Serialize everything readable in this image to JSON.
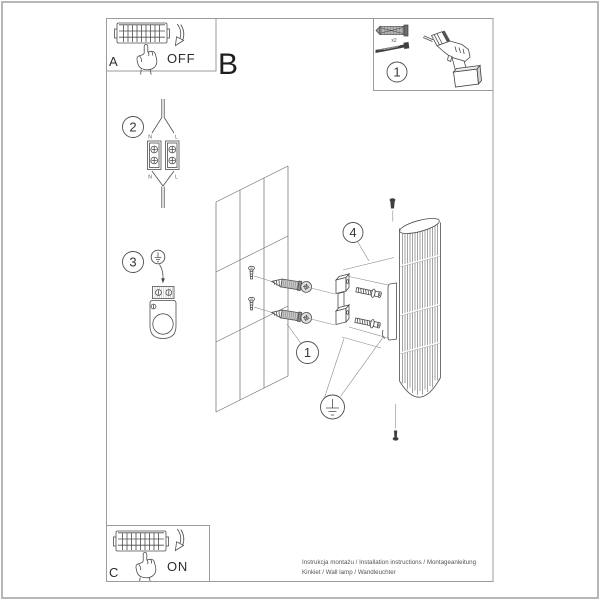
{
  "panels": {
    "power_off": {
      "label": "A",
      "state": "OFF"
    },
    "section": {
      "label": "B"
    },
    "tools": {
      "number": "1",
      "quantity": "x2"
    },
    "power_on": {
      "label": "C",
      "state": "ON"
    }
  },
  "steps": {
    "connector": {
      "number": "2",
      "terminals": {
        "top_left": "N",
        "top_right": "L",
        "bottom_left": "N",
        "bottom_right": "L"
      }
    },
    "ground": {
      "number": "3"
    },
    "anchors": {
      "number": "1"
    },
    "bracket": {
      "number": "4"
    }
  },
  "footer": {
    "line1": "Instrukcja montażu / Installation instructions / Montageanleitung",
    "line2": "Kinkiet / Wall lamp / Wandleuchter"
  }
}
